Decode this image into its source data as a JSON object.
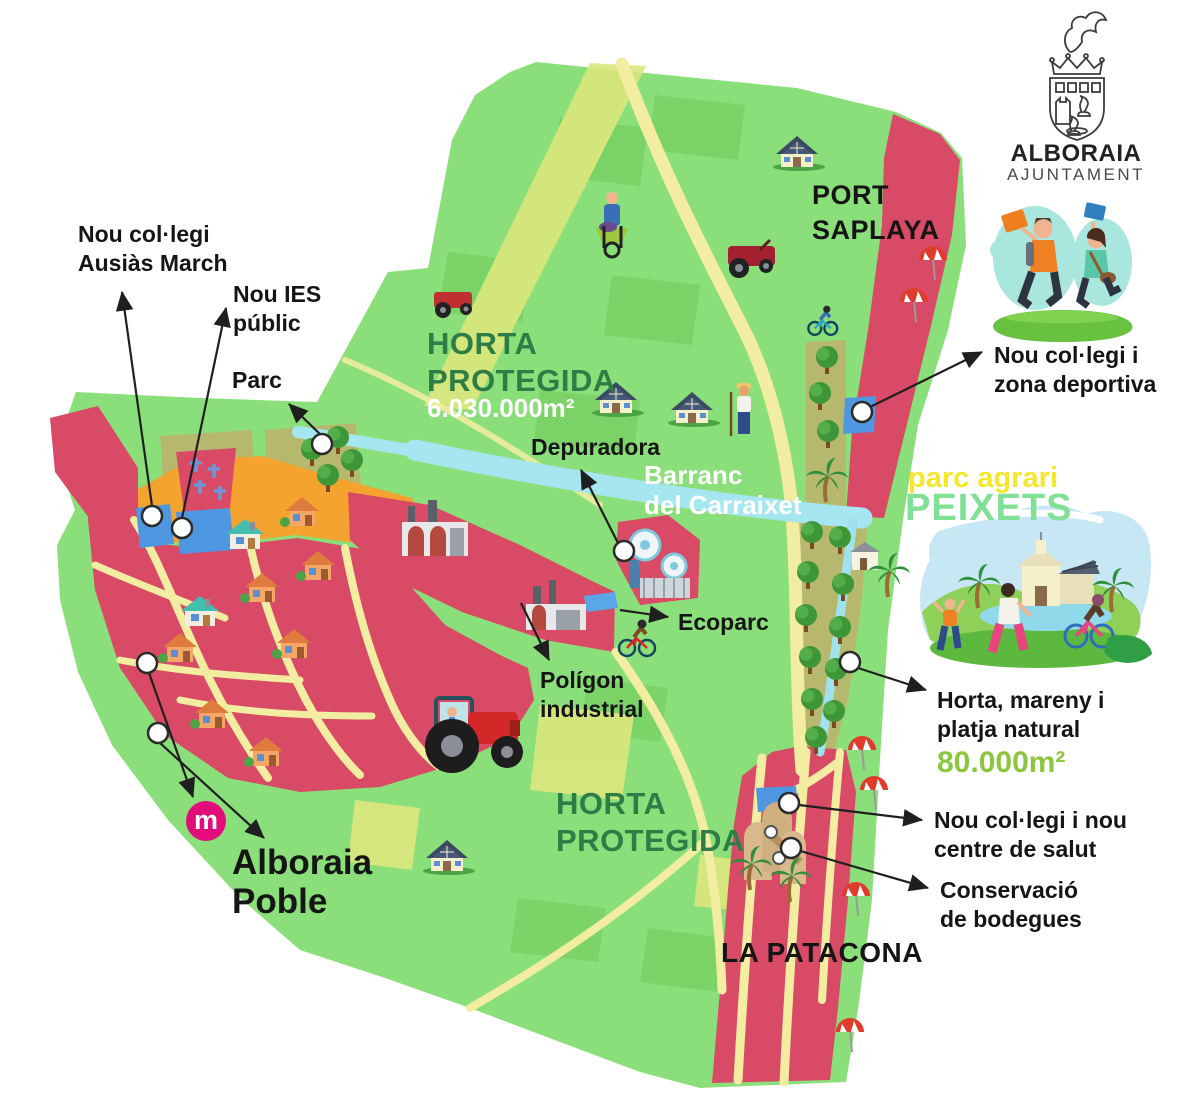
{
  "logo": {
    "name": "ALBORAIA",
    "subtitle": "AJUNTAMENT"
  },
  "areas": {
    "horta_north": {
      "title": "HORTA\nPROTEGIDA",
      "area": "6.030.000m²"
    },
    "horta_south": {
      "title": "HORTA\nPROTEGIDA"
    },
    "port_saplaya": "PORT\nSAPLAYA",
    "la_patacona": "LA PATACONA",
    "alboraia_poble": "Alboraia\nPoble",
    "barranc": "Barranc\ndel Carraixet",
    "parc_agrari": {
      "line1": "parc agrari",
      "line2": "PEIXETS"
    },
    "horta_mareny": {
      "label": "Horta, mareny i\nplatja natural",
      "area": "80.000m²"
    }
  },
  "callouts": {
    "school_ausias": "Nou col·legi\nAusiàs March",
    "ies": "Nou IES\npúblic",
    "parc": "Parc",
    "depuradora": "Depuradora",
    "ecoparc": "Ecoparc",
    "poligon": "Polígon\nindustrial",
    "school_sports": "Nou col·legi i\nzona deportiva",
    "school_health": "Nou col·legi i nou\ncentre de salut",
    "bodegues": "Conservació\nde bodegues"
  },
  "metro": {
    "symbol": "m"
  },
  "colors": {
    "map_green": "#8bdf7a",
    "field_dark_green": "#7ad166",
    "field_lime": "#dbe77d",
    "urban_pink": "#d84a66",
    "road_cream": "#f3eda2",
    "orange_zone": "#f4a32e",
    "olive_strip": "#b6b96d",
    "river_blue": "#a6e6f0",
    "site_blue": "#4f97e0",
    "metro_pink": "#e20c7b",
    "title_green": "#2e7d46",
    "area_green": "#8cc63f",
    "peixets_green": "#7fe096",
    "agrari_yellow": "#f5e62e"
  },
  "icons": {
    "metro-station-badge": "m in magenta circle",
    "tree": "round green tree",
    "palm-tree": "palm",
    "house": "village house",
    "solar-house": "farmhouse with solar roof",
    "factory": "industrial building",
    "tractor": "red tractor",
    "water-treatment": "depuradora tanks",
    "beach-umbrella": "red parasol",
    "wine-cellar": "old bodega arches",
    "coat-of-arms": "Alboraia crest",
    "marker-dot": "white leader dot"
  }
}
